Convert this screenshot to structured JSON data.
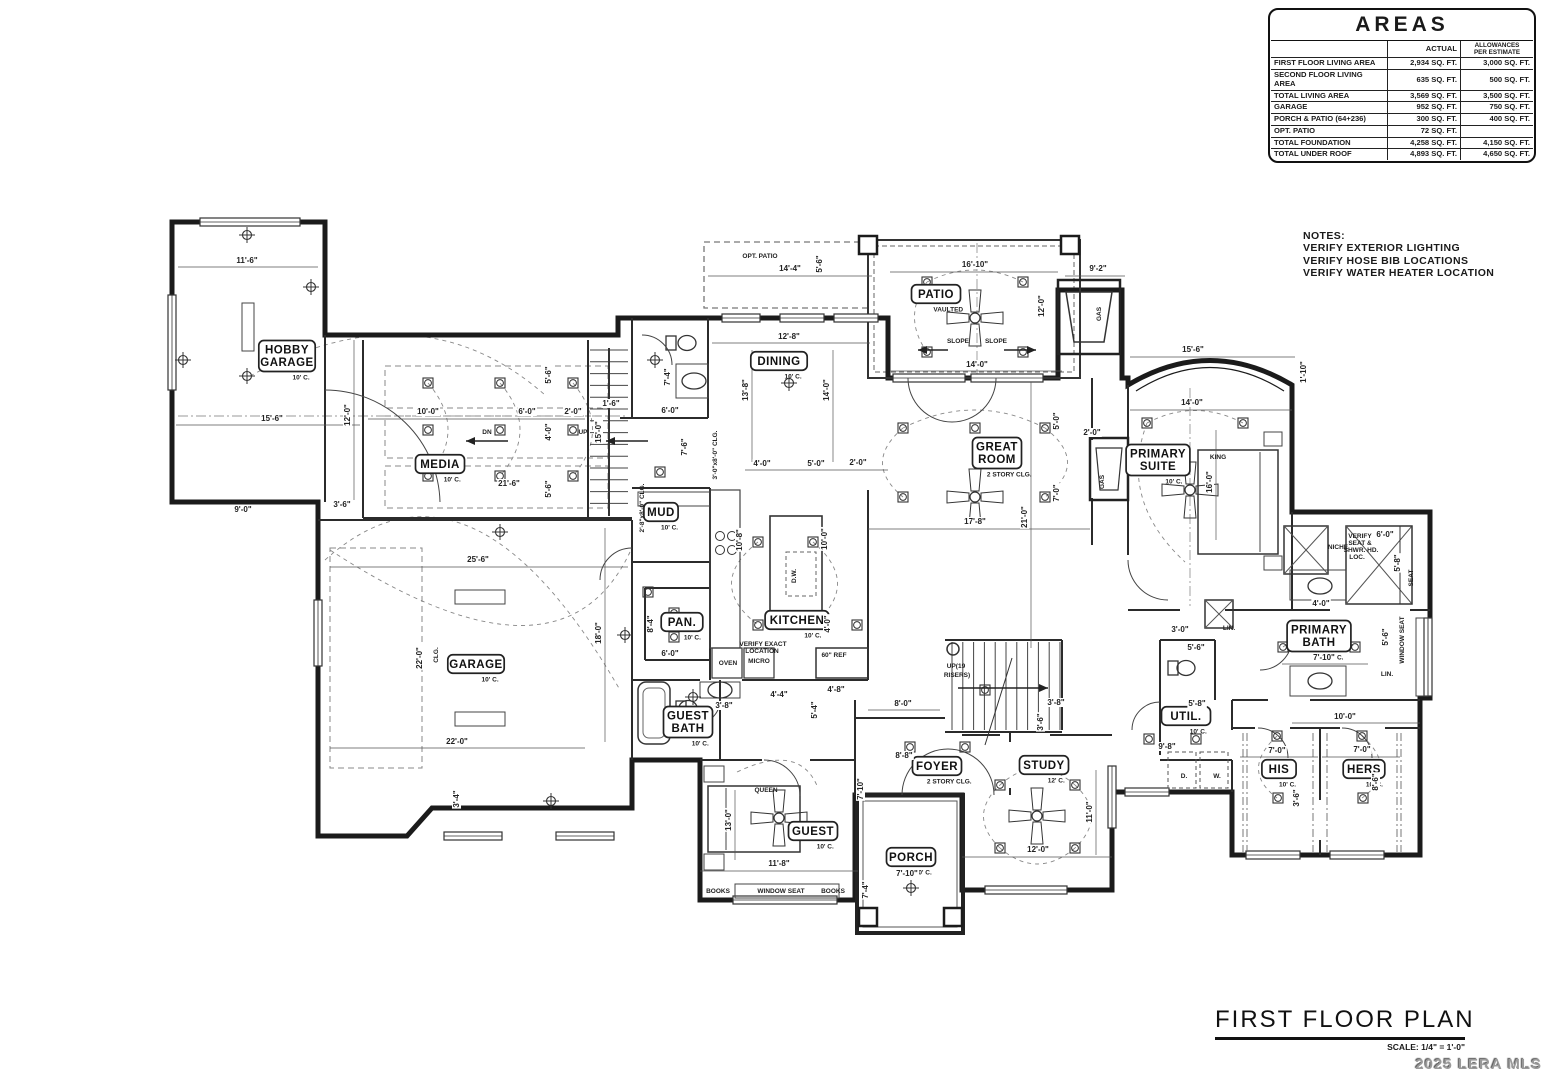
{
  "areas_table": {
    "title": "AREAS",
    "col_headers": [
      "",
      "ACTUAL",
      "ALLOWANCES\nPER ESTIMATE"
    ],
    "rows": [
      {
        "label": "FIRST FLOOR LIVING AREA",
        "actual": "2,934 SQ. FT.",
        "allowance": "3,000 SQ. FT."
      },
      {
        "label": "SECOND FLOOR LIVING AREA",
        "actual": "635 SQ. FT.",
        "allowance": "500 SQ. FT."
      },
      {
        "label": "TOTAL LIVING AREA",
        "actual": "3,569 SQ. FT.",
        "allowance": "3,500 SQ. FT."
      },
      {
        "label": "GARAGE",
        "actual": "952 SQ. FT.",
        "allowance": "750 SQ. FT."
      },
      {
        "label": "PORCH & PATIO (64+236)",
        "actual": "300 SQ. FT.",
        "allowance": "400 SQ. FT."
      },
      {
        "label": "OPT. PATIO",
        "actual": "72 SQ. FT.",
        "allowance": ""
      },
      {
        "label": "TOTAL FOUNDATION",
        "actual": "4,258 SQ. FT.",
        "allowance": "4,150 SQ. FT."
      },
      {
        "label": "TOTAL UNDER ROOF",
        "actual": "4,893 SQ. FT.",
        "allowance": "4,650 SQ. FT."
      }
    ]
  },
  "notes": {
    "heading": "NOTES:",
    "lines": [
      "VERIFY EXTERIOR LIGHTING",
      "VERIFY HOSE BIB LOCATIONS",
      "VERIFY WATER HEATER LOCATION"
    ]
  },
  "title_block": {
    "title": "FIRST FLOOR PLAN",
    "scale": "SCALE: 1/4\" = 1'-0\""
  },
  "watermark": "2025 LERA MLS",
  "plan": {
    "rooms": [
      {
        "n": "HOBBY\nGARAGE",
        "s": "10' C.",
        "x": 287,
        "y": 356
      },
      {
        "n": "MEDIA",
        "s": "10' C.",
        "x": 440,
        "y": 464
      },
      {
        "n": "GARAGE",
        "s": "10' C.",
        "x": 476,
        "y": 664
      },
      {
        "n": "MUD",
        "s": "10' C.",
        "x": 661,
        "y": 512
      },
      {
        "n": "PAN.",
        "s": "10' C.",
        "x": 682,
        "y": 622
      },
      {
        "n": "KITCHEN",
        "s": "10' C.",
        "x": 797,
        "y": 620
      },
      {
        "n": "DINING",
        "s": "10' C.",
        "x": 779,
        "y": 361
      },
      {
        "n": "GREAT\nROOM",
        "s": "2 STORY CLG.",
        "x": 997,
        "y": 453
      },
      {
        "n": "PATIO",
        "s": "VAULTED",
        "x": 936,
        "y": 294
      },
      {
        "n": "PRIMARY\nSUITE",
        "s": "10' C.",
        "x": 1158,
        "y": 460
      },
      {
        "n": "PRIMARY\nBATH",
        "s": "10' C.",
        "x": 1319,
        "y": 636
      },
      {
        "n": "GUEST\nBATH",
        "s": "10' C.",
        "x": 688,
        "y": 722
      },
      {
        "n": "GUEST",
        "s": "10' C.",
        "x": 813,
        "y": 831
      },
      {
        "n": "FOYER",
        "s": "2 STORY CLG.",
        "x": 937,
        "y": 766
      },
      {
        "n": "STUDY",
        "s": "12' C.",
        "x": 1044,
        "y": 765
      },
      {
        "n": "PORCH",
        "s": "10' C.",
        "x": 911,
        "y": 857
      },
      {
        "n": "UTIL.",
        "s": "10' C.",
        "x": 1186,
        "y": 716
      },
      {
        "n": "HIS",
        "s": "10' C.",
        "x": 1279,
        "y": 769
      },
      {
        "n": "HERS",
        "s": "10' C.",
        "x": 1364,
        "y": 769
      }
    ],
    "dims": [
      {
        "t": "11'-6\"",
        "x": 247,
        "y": 263
      },
      {
        "t": "15'-6\"",
        "x": 272,
        "y": 421
      },
      {
        "t": "12'-0\"",
        "x": 350,
        "y": 415,
        "r": 1
      },
      {
        "t": "9'-0\"",
        "x": 243,
        "y": 512
      },
      {
        "t": "3'-6\"",
        "x": 342,
        "y": 507
      },
      {
        "t": "10'-0\"",
        "x": 428,
        "y": 414
      },
      {
        "t": "6'-0\"",
        "x": 527,
        "y": 414
      },
      {
        "t": "2'-0\"",
        "x": 573,
        "y": 414
      },
      {
        "t": "4'-0\"",
        "x": 551,
        "y": 432,
        "r": 1
      },
      {
        "t": "15'-0\"",
        "x": 601,
        "y": 432,
        "r": 1
      },
      {
        "t": "5'-6\"",
        "x": 551,
        "y": 375,
        "r": 1
      },
      {
        "t": "5'-6\"",
        "x": 551,
        "y": 489,
        "r": 1
      },
      {
        "t": "21'-6\"",
        "x": 509,
        "y": 486
      },
      {
        "t": "1'-6\"",
        "x": 611,
        "y": 406
      },
      {
        "t": "25'-6\"",
        "x": 478,
        "y": 562
      },
      {
        "t": "22'-0\"",
        "x": 422,
        "y": 658,
        "r": 1
      },
      {
        "t": "18'-0\"",
        "x": 601,
        "y": 633,
        "r": 1
      },
      {
        "t": "22'-0\"",
        "x": 457,
        "y": 744
      },
      {
        "t": "3'-4\"",
        "x": 459,
        "y": 799,
        "r": 1
      },
      {
        "t": "14'-4\"",
        "x": 790,
        "y": 271
      },
      {
        "t": "5'-6\"",
        "x": 822,
        "y": 264,
        "r": 1
      },
      {
        "t": "16'-10\"",
        "x": 975,
        "y": 267
      },
      {
        "t": "9'-2\"",
        "x": 1098,
        "y": 271
      },
      {
        "t": "12'-0\"",
        "x": 1044,
        "y": 306,
        "r": 1
      },
      {
        "t": "14'-0\"",
        "x": 977,
        "y": 367
      },
      {
        "t": "12'-8\"",
        "x": 789,
        "y": 339
      },
      {
        "t": "13'-8\"",
        "x": 748,
        "y": 390,
        "r": 1
      },
      {
        "t": "14'-0\"",
        "x": 829,
        "y": 390,
        "r": 1
      },
      {
        "t": "6'-0\"",
        "x": 670,
        "y": 413
      },
      {
        "t": "7'-4\"",
        "x": 670,
        "y": 377,
        "r": 1
      },
      {
        "t": "7'-6\"",
        "x": 687,
        "y": 447,
        "r": 1
      },
      {
        "t": "4'-0\"",
        "x": 762,
        "y": 466
      },
      {
        "t": "5'-0\"",
        "x": 816,
        "y": 466
      },
      {
        "t": "2'-0\"",
        "x": 858,
        "y": 465
      },
      {
        "t": "15'-6\"",
        "x": 1193,
        "y": 352
      },
      {
        "t": "14'-0\"",
        "x": 1192,
        "y": 405
      },
      {
        "t": "1'-10\"",
        "x": 1306,
        "y": 372,
        "r": 1
      },
      {
        "t": "16'-0\"",
        "x": 1212,
        "y": 482,
        "r": 1
      },
      {
        "t": "17'-8\"",
        "x": 975,
        "y": 524
      },
      {
        "t": "21'-0\"",
        "x": 1027,
        "y": 517,
        "r": 1
      },
      {
        "t": "7'-0\"",
        "x": 1059,
        "y": 493,
        "r": 1
      },
      {
        "t": "5'-0\"",
        "x": 1059,
        "y": 421,
        "r": 1
      },
      {
        "t": "2'-0\"",
        "x": 1092,
        "y": 435
      },
      {
        "t": "10'-8\"",
        "x": 742,
        "y": 540,
        "r": 1
      },
      {
        "t": "10'-0\"",
        "x": 827,
        "y": 539,
        "r": 1
      },
      {
        "t": "8'-4\"",
        "x": 653,
        "y": 624,
        "r": 1
      },
      {
        "t": "6'-0\"",
        "x": 670,
        "y": 656
      },
      {
        "t": "4'-0\"",
        "x": 830,
        "y": 624,
        "r": 1
      },
      {
        "t": "3'-8\"",
        "x": 724,
        "y": 708
      },
      {
        "t": "4'-4\"",
        "x": 779,
        "y": 697
      },
      {
        "t": "5'-4\"",
        "x": 817,
        "y": 710,
        "r": 1
      },
      {
        "t": "4'-8\"",
        "x": 836,
        "y": 692
      },
      {
        "t": "8'-0\"",
        "x": 903,
        "y": 706
      },
      {
        "t": "8'-8\"",
        "x": 904,
        "y": 758
      },
      {
        "t": "7'-10\"",
        "x": 863,
        "y": 789,
        "r": 1
      },
      {
        "t": "3'-8\"",
        "x": 1056,
        "y": 705
      },
      {
        "t": "3'-6\"",
        "x": 1043,
        "y": 722,
        "r": 1
      },
      {
        "t": "13'-0\"",
        "x": 731,
        "y": 820,
        "r": 1
      },
      {
        "t": "11'-8\"",
        "x": 779,
        "y": 866
      },
      {
        "t": "12'-0\"",
        "x": 1038,
        "y": 852
      },
      {
        "t": "11'-0\"",
        "x": 1092,
        "y": 812,
        "r": 1
      },
      {
        "t": "7'-10\"",
        "x": 907,
        "y": 876
      },
      {
        "t": "7'-4\"",
        "x": 868,
        "y": 890,
        "r": 1
      },
      {
        "t": "6'-0\"",
        "x": 1385,
        "y": 537
      },
      {
        "t": "5'-8\"",
        "x": 1400,
        "y": 563,
        "r": 1
      },
      {
        "t": "4'-0\"",
        "x": 1321,
        "y": 606
      },
      {
        "t": "5'-6\"",
        "x": 1388,
        "y": 637,
        "r": 1
      },
      {
        "t": "7'-10\"",
        "x": 1324,
        "y": 660
      },
      {
        "t": "3'-0\"",
        "x": 1180,
        "y": 632
      },
      {
        "t": "5'-6\"",
        "x": 1196,
        "y": 650
      },
      {
        "t": "5'-8\"",
        "x": 1197,
        "y": 706
      },
      {
        "t": "9'-8\"",
        "x": 1167,
        "y": 749
      },
      {
        "t": "10'-0\"",
        "x": 1345,
        "y": 719
      },
      {
        "t": "7'-0\"",
        "x": 1277,
        "y": 753
      },
      {
        "t": "7'-0\"",
        "x": 1362,
        "y": 752
      },
      {
        "t": "3'-6\"",
        "x": 1299,
        "y": 798,
        "r": 1
      },
      {
        "t": "8'-6\"",
        "x": 1378,
        "y": 782,
        "r": 1
      }
    ],
    "annotations": [
      {
        "t": "OPT. PATIO",
        "x": 760,
        "y": 258
      },
      {
        "t": "DN",
        "x": 487,
        "y": 434
      },
      {
        "t": "UP",
        "x": 583,
        "y": 434
      },
      {
        "t": "SLOPE",
        "x": 958,
        "y": 343
      },
      {
        "t": "SLOPE",
        "x": 996,
        "y": 343
      },
      {
        "t": "GAS",
        "x": 1101,
        "y": 314,
        "r": 1
      },
      {
        "t": "GAS",
        "x": 1104,
        "y": 482,
        "r": 1
      },
      {
        "t": "QUEEN",
        "x": 766,
        "y": 792
      },
      {
        "t": "KING",
        "x": 1218,
        "y": 459
      },
      {
        "t": "BOOKS",
        "x": 718,
        "y": 893
      },
      {
        "t": "WINDOW SEAT",
        "x": 781,
        "y": 893
      },
      {
        "t": "BOOKS",
        "x": 833,
        "y": 893
      },
      {
        "t": "WINDOW SEAT",
        "x": 1404,
        "y": 640,
        "r": 1
      },
      {
        "t": "SEAT",
        "x": 1413,
        "y": 578,
        "r": 1
      },
      {
        "t": "NICHE",
        "x": 1338,
        "y": 549
      },
      {
        "t": "LIN.",
        "x": 1387,
        "y": 676
      },
      {
        "t": "LIN.",
        "x": 1229,
        "y": 630
      },
      {
        "t": "OVEN",
        "x": 728,
        "y": 665
      },
      {
        "t": "MICRO",
        "x": 759,
        "y": 663
      },
      {
        "t": "VERIFY EXACT",
        "x": 763,
        "y": 646
      },
      {
        "t": "LOCATION",
        "x": 762,
        "y": 653
      },
      {
        "t": "60\" REF",
        "x": 834,
        "y": 657
      },
      {
        "t": "D.W.",
        "x": 796,
        "y": 576,
        "r": 1
      },
      {
        "t": "D.",
        "x": 1184,
        "y": 778
      },
      {
        "t": "W.",
        "x": 1217,
        "y": 778
      },
      {
        "t": "UP(19",
        "x": 956,
        "y": 668
      },
      {
        "t": "RISERS)",
        "x": 957,
        "y": 677
      },
      {
        "t": "VERIFY",
        "x": 1360,
        "y": 538
      },
      {
        "t": "SEAT &",
        "x": 1360,
        "y": 545
      },
      {
        "t": "SHWR. HD.",
        "x": 1361,
        "y": 552
      },
      {
        "t": "LOC.",
        "x": 1357,
        "y": 559
      },
      {
        "t": "3'-0\"x8'-0\" CLG.",
        "x": 717,
        "y": 455,
        "r": 1
      },
      {
        "t": "2'-8\"x8'-0\" CLG.",
        "x": 644,
        "y": 508,
        "r": 1
      },
      {
        "t": "CLG.",
        "x": 438,
        "y": 655,
        "r": 1
      }
    ]
  }
}
